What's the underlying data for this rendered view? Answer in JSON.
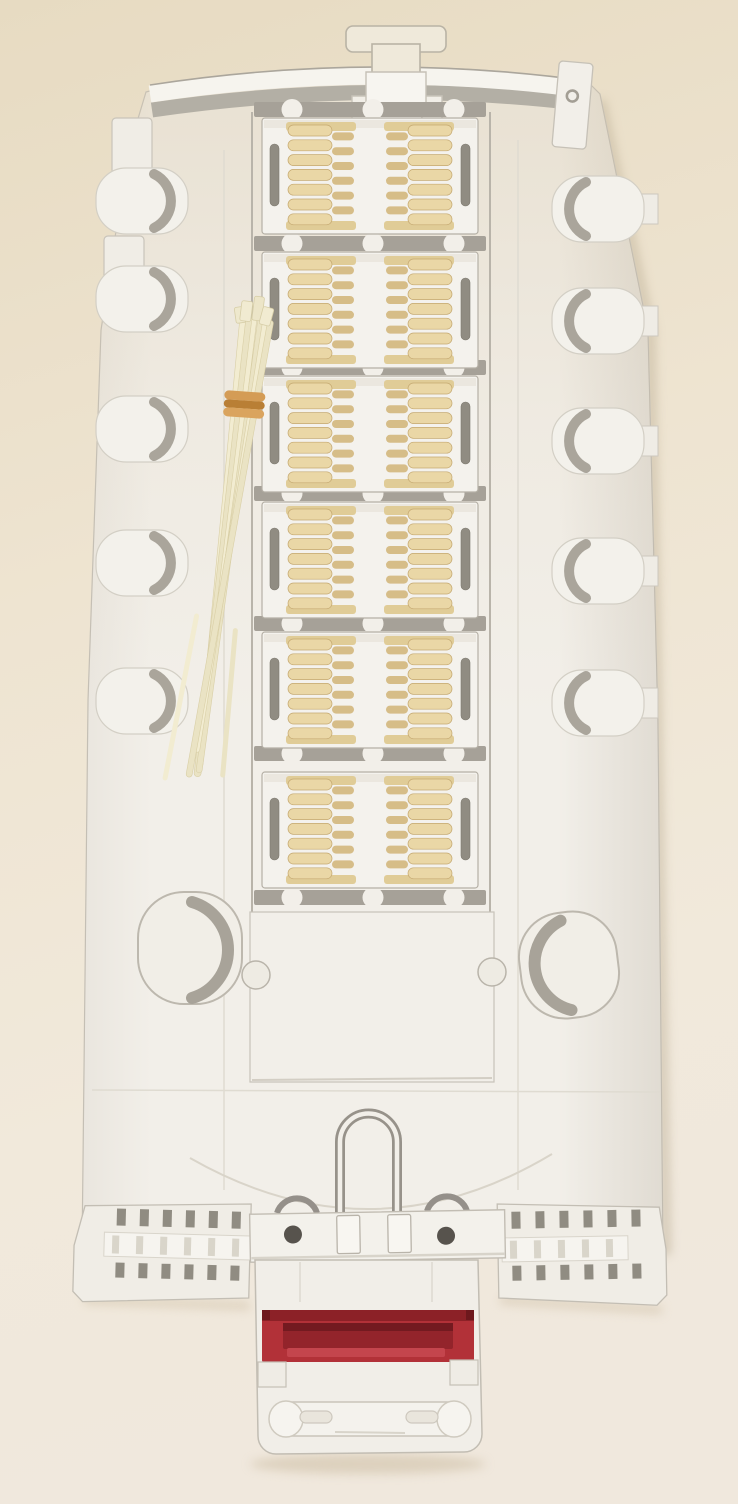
{
  "scene": {
    "title": "fiber-optic-splice-tray-photo",
    "colors": {
      "bg_top": "#e7dbc2",
      "bg_mid": "#eee4d1",
      "bg_bottom": "#f0e8dd",
      "tray": "#f2efe9",
      "tray_bright": "#f6f4ef",
      "tray_stroke": "#c3beb4",
      "shadow": "#aaa59b",
      "crevice": "#97928a",
      "module_frame": "#f4f2ed",
      "module_stroke": "#b5b0a6",
      "scallop_bar": "#a6a198",
      "slot": "#908c82",
      "comb_finger": "#ead7a6",
      "comb_tooth": "#d6bd88",
      "comb_spine": "#e0cc97",
      "comb_stroke": "#c5a971",
      "strand": "#f2ecd1",
      "strand_alt": "#eae3c4",
      "strand_edge": "#d9cfa6",
      "band_dark": "#b97f35",
      "band_light": "#d49c55",
      "label_red": "#b23138",
      "label_dark": "#8c2127",
      "label_recess": "#93242b",
      "label_lip": "#c4454d",
      "hole": "#57534d",
      "ridge": "#d9d5ca"
    },
    "splice_modules": {
      "count": 6,
      "x": 262,
      "width": 216,
      "height": 116,
      "ys": [
        118,
        252,
        376,
        502,
        632,
        772
      ],
      "fingers_per_comb": 7,
      "teeth_per_comb": 6,
      "finger_pitch": 14.8,
      "scallop_bar_ys": [
        102,
        236,
        360,
        486,
        616,
        746,
        890
      ],
      "scallop_cx": [
        292,
        373,
        454
      ]
    },
    "left_tabs": {
      "x": 96,
      "width": 92,
      "height": 66,
      "ys": [
        168,
        266,
        396,
        530,
        668
      ]
    },
    "right_tabs": {
      "x": 552,
      "width": 92,
      "height": 66,
      "ys": [
        176,
        288,
        408,
        538,
        670
      ]
    },
    "cable_tie_bundle": {
      "origin": [
        253,
        318
      ],
      "angle_deg": 7,
      "strand_offsets": [
        -13,
        -7,
        -1,
        5,
        10,
        15
      ],
      "strand_lengths": [
        452,
        462,
        448,
        458,
        438,
        464
      ],
      "strand_widths": [
        6,
        7,
        5,
        6,
        5,
        6
      ],
      "strand_rotations": [
        -1.5,
        -0.5,
        0,
        0.8,
        2,
        3.2
      ],
      "band_y": 74
    },
    "wings": {
      "slot_count": 6,
      "left_slot_x0": 116,
      "left_slot_pitch": 23,
      "right_slot_x0": 512,
      "right_slot_pitch": 24,
      "top_slot_y": 1212,
      "bottom_slot_y": 1266
    },
    "hinge": {
      "hole_left": [
        293,
        1233
      ],
      "hole_right": [
        446,
        1237
      ],
      "hole_r": 9
    }
  }
}
